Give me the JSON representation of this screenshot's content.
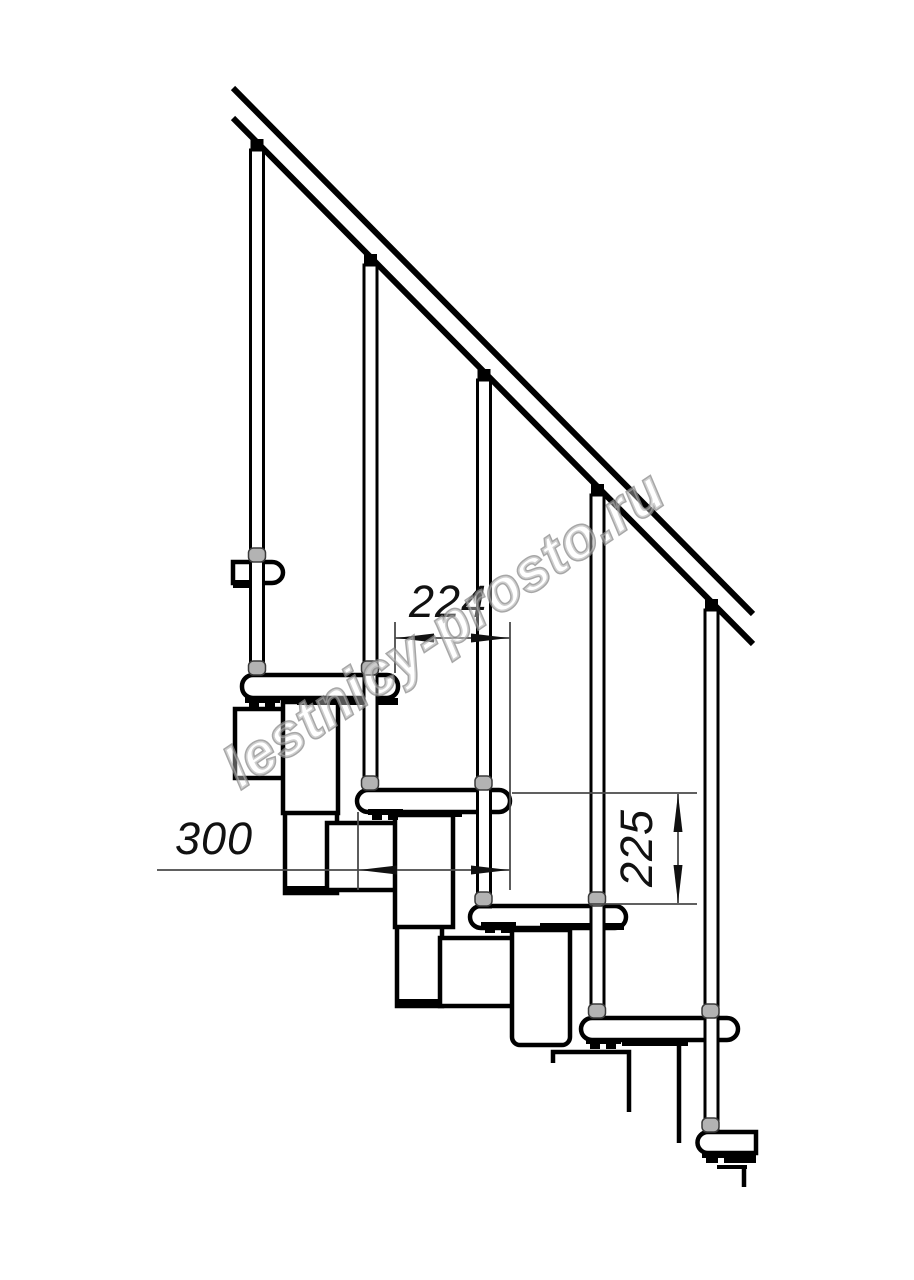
{
  "page": {
    "background": "#ffffff",
    "width": 914,
    "height": 1280
  },
  "drawing": {
    "kind": "technical-line-drawing",
    "subject": "modular staircase side elevation",
    "line_color": "#000000",
    "dim_line_color": "#4a4a4a",
    "dim_text_color": "#111111",
    "bead_color": "#b3b3b3",
    "watermark": {
      "text": "lestnicy-prosto.ru",
      "color": "#8a8a8a"
    },
    "dimensions": {
      "step_offset": {
        "label": "224"
      },
      "tread_depth": {
        "label": "300"
      },
      "step_rise": {
        "label": "225"
      }
    }
  }
}
